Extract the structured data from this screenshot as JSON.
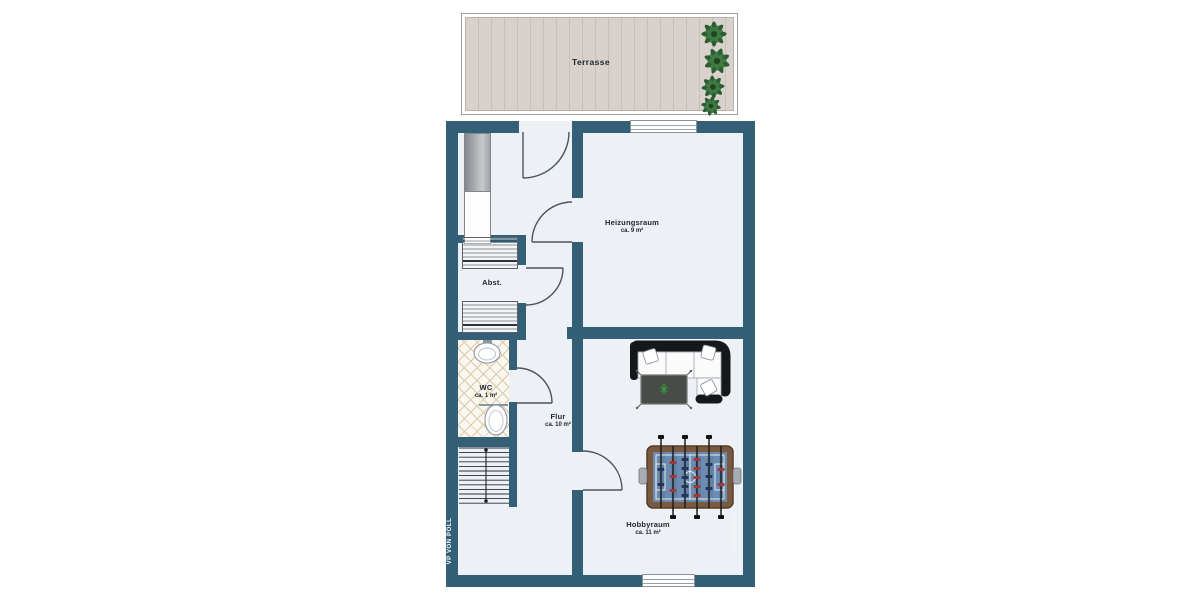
{
  "title": "Kellergeschoss Grundriss",
  "colors": {
    "wall": "#336077",
    "floor": "#edf0f5",
    "deck_wood": "#d8d1cc",
    "tile_line": "#dcc9a6",
    "plant_green": "#2c5c31",
    "foosball_field": "#6b8cb0",
    "foosball_frame": "#7a5a3e",
    "label_text": "#1d242c"
  },
  "terrace": {
    "label": "Terrasse"
  },
  "rooms": {
    "heizungsraum": {
      "name": "Heizungsraum",
      "area": "ca. 9 m²"
    },
    "abstellraum": {
      "name": "Abst."
    },
    "wc": {
      "name": "WC",
      "area": "ca. 1 m²"
    },
    "flur": {
      "name": "Flur",
      "area": "ca. 10 m²"
    },
    "hobbyraum": {
      "name": "Hobbyraum",
      "area": "ca. 11 m²"
    }
  },
  "branding": {
    "logo_vertical": "VP VON POLL",
    "watermark_vertical": "VP VON POLL"
  },
  "furniture": {
    "wardrobe": "wardrobe",
    "appliances": "washer-dryer-pair",
    "sink": "wash-basin",
    "toilet": "toilet",
    "stairs": "staircase-down",
    "sofa": "corner-sofa",
    "coffee_table": "coffee-table",
    "foosball": "foosball-table",
    "plants": "potted-plants"
  }
}
